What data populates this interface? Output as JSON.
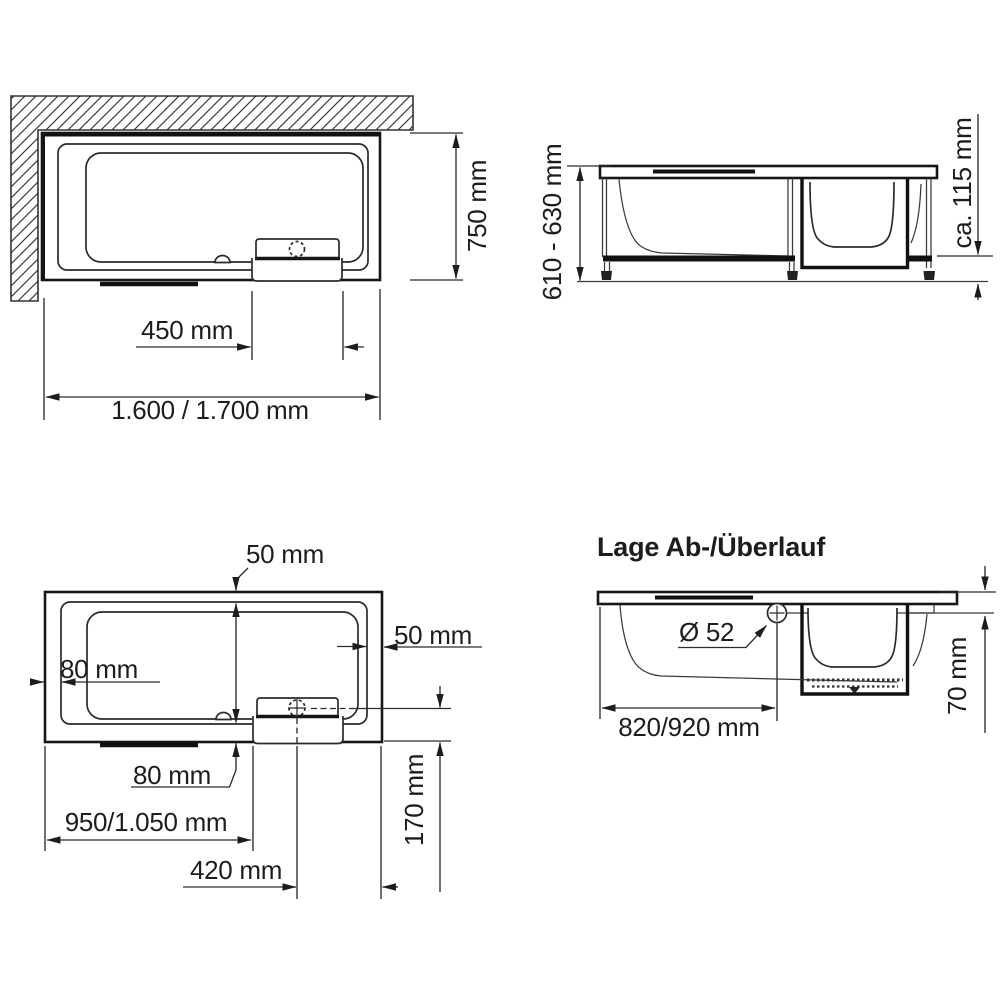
{
  "drawing": {
    "background": "#ffffff",
    "line_color": "#333333",
    "strong_line_color": "#111111",
    "views": {
      "top_view_installed": {
        "dim_depth": "750 mm",
        "dim_seat_width": "450 mm",
        "dim_total_length": "1.600 / 1.700 mm"
      },
      "side_view": {
        "dim_height": "610 - 630 mm",
        "dim_base_clearance": "ca. 115 mm"
      },
      "top_view_dimensions": {
        "dim_rim_top": "50 mm",
        "dim_rim_right": "50 mm",
        "dim_rim_left": "80 mm",
        "dim_rim_bottom": "80 mm",
        "dim_drain_from_left": "950/1.050 mm",
        "dim_drain_to_right_edge": "420 mm",
        "dim_drain_from_front": "170 mm"
      },
      "overflow_view": {
        "title": "Lage Ab-/Überlauf",
        "dim_overflow_diameter": "Ø 52",
        "dim_overflow_from_left": "820/920 mm",
        "dim_overflow_below_rim": "70 mm"
      }
    }
  }
}
